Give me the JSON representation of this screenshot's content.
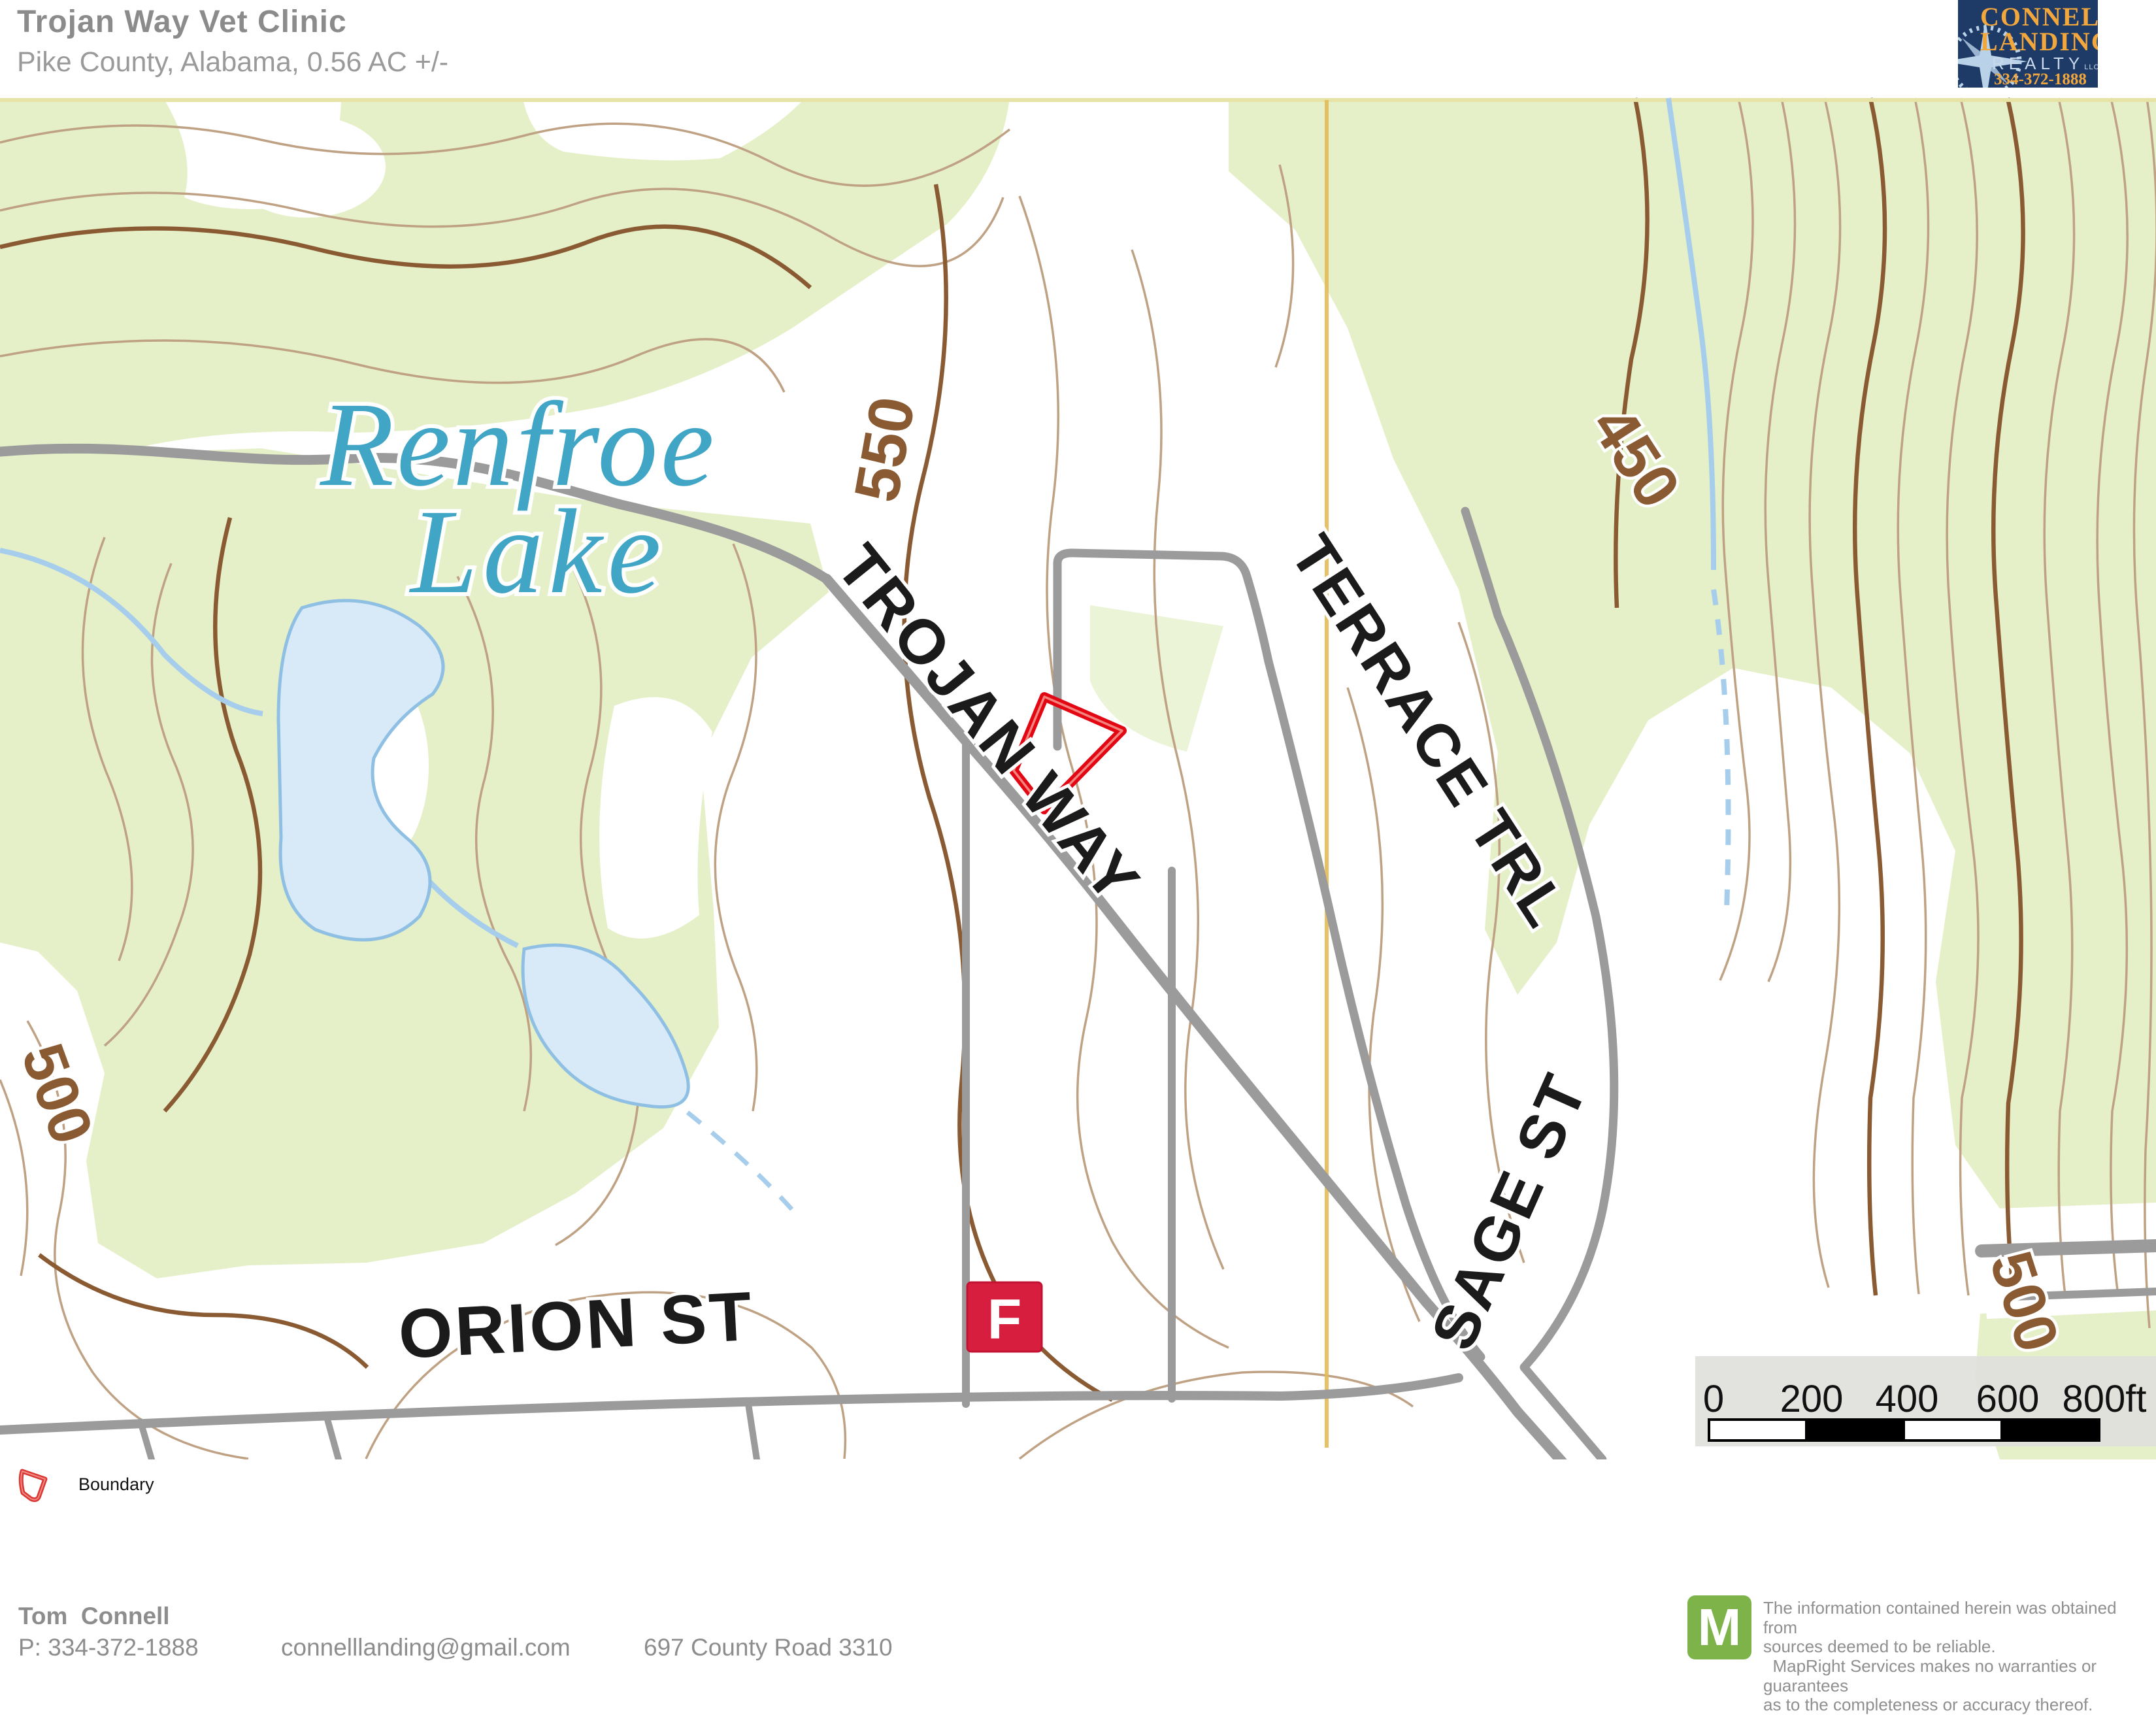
{
  "header": {
    "title": "Trojan Way Vet Clinic",
    "subtitle": "Pike County, Alabama, 0.56 AC +/-"
  },
  "logo": {
    "line1": "CONNELL",
    "line2": "LANDING",
    "line3": "REALTY",
    "llc": "LLC",
    "phone": "334-372-1888",
    "bg_color": "#1e3a67",
    "gold_color": "#f2a73d"
  },
  "map": {
    "labels": {
      "lake_line1": "Renfroe",
      "lake_line2": "Lake",
      "road_trojan": "TROJAN WAY",
      "road_terrace": "TERRACE TRL",
      "road_sage": "SAGE ST",
      "road_orion": "ORION ST",
      "contour_550": "550",
      "contour_450": "450",
      "contour_500_left": "500",
      "contour_500_right": "500"
    },
    "marker": {
      "label": "F",
      "color": "#d81e3f"
    },
    "scalebar": {
      "ticks": [
        "0",
        "200",
        "400",
        "600",
        "800ft"
      ]
    },
    "colors": {
      "vegetation": "#e5f0c8",
      "water_fill": "#d8eaf8",
      "water_edge": "#8fc0e4",
      "contour": "#bfa184",
      "contour_index": "#8a5a33",
      "road": "#9b9b9b",
      "boundary_red": "#e30613",
      "plss_yellow": "#e3ba55"
    }
  },
  "legend": {
    "boundary_label": "Boundary"
  },
  "footer": {
    "name": "Tom  Connell",
    "phone": "P: 334-372-1888",
    "email": "connelllanding@gmail.com",
    "address": "697 County Road 3310"
  },
  "disclaimer": {
    "logo_letter": "M",
    "logo_color": "#7db348",
    "line1": "The information contained herein was obtained from",
    "line2": "sources deemed to be reliable.",
    "line3": "  MapRight Services makes no warranties or guarantees",
    "line4": "as to the completeness or accuracy thereof."
  }
}
